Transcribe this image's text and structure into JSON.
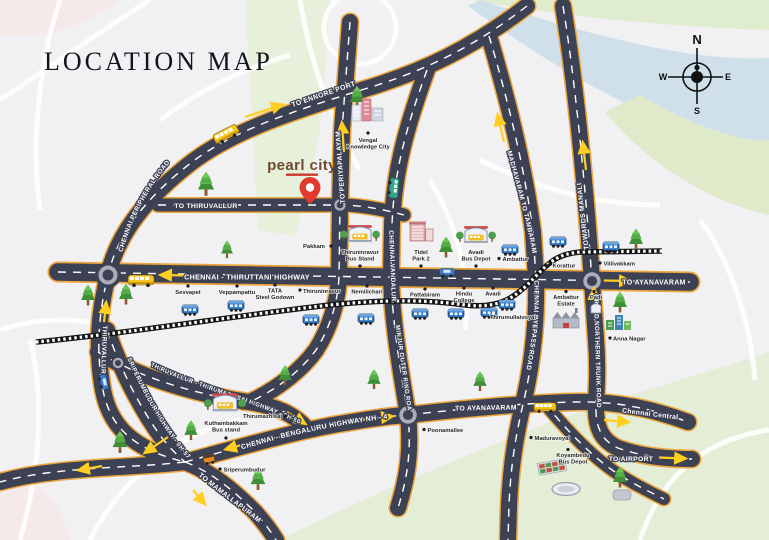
{
  "title": "LOCATION MAP",
  "logo": {
    "text": "pearl city"
  },
  "compass": {
    "n": "N",
    "s": "S",
    "e": "E",
    "w": "W"
  },
  "roads": {
    "ennore": "TO ENNORE PORT",
    "peripheral": "CHENNAI PERIPHERAL ROAD",
    "to_thiruvallur": "TO THIRUVALLUR",
    "periyapalayam": "TO PERIYAPALAYAM",
    "thiruttani": "CHENNAI - THIRUTTANI HIGHWAY",
    "vandalur": "CHENNAI VANDALUR",
    "minjur": "MINJUR OUTER RING ROAD",
    "madhavaram": "MADHAVARAM TO TAMBARAM",
    "manali": "TOWARDS MANALI",
    "byepass": "CHENNAI BYEPASS ROAD",
    "grand_northern": "GRAND NORTHERN TRUNK ROAD",
    "thiruvallur_v": "THIRUVALLUR -",
    "sh57": "SRIPERUMBUDUR HIGHWAY - SH-57",
    "sh50": "THIRUVALLUR - THIRUMAZHISAI HIGHWAY - SH-50",
    "nh4": "CHENNAI - BENGALURU HIGHWAY NH - 4",
    "mamallapuram": "TO MAMALLAPURAM",
    "ayanavaram_north": "TO AYANAVARAM",
    "ayanavaram_south": "TO AYANAVARAM",
    "central": "Chennai Central",
    "airport": "TO AIRPORT"
  },
  "places": {
    "vengal_knowledge_city": [
      "Vengal",
      "Knowledge City"
    ],
    "pakkam": "Pakkam",
    "thiruninravur_bus_stand": [
      "Thiruninravur",
      "Bus Stand"
    ],
    "tidel_park": [
      "Tidel",
      "Park 2"
    ],
    "avadi_bus_depot": [
      "Avadi",
      "Bus Depot"
    ],
    "ambattur": "Ambattur",
    "korattur": "Korattur",
    "villivakkam": "Villivakkam",
    "sevvapet": "Sevvapet",
    "veppampattu": "Veppampattu",
    "tata_steel": [
      "TATA",
      "Steel Godown"
    ],
    "thiruninravur": "Thiruninravur",
    "nemilichari": "Nemilichari",
    "pattabiram": "Pattabiram",
    "hindu_college": [
      "Hindu",
      "College"
    ],
    "avadi": "Avadi",
    "thirumullaivoyal": "Thirumullaivoyal",
    "ambattur_estate": [
      "Ambattur",
      "Estate"
    ],
    "padi": "Padi",
    "anna_nagar": "Anna Nagar",
    "kuthambakkam_bus_stand": [
      "Kuthambakkam",
      "Bus stand"
    ],
    "thirumazhisai": "Thirumazhisai",
    "sriperumbudur": "Sriperumbudur",
    "poonamallee": "Poonamallee",
    "maduravoyal": "Maduravoyal",
    "koyambedu_bus_depot": [
      "Koyambedu",
      "Bus Depot"
    ]
  },
  "icons": [
    "compass-rose-icon",
    "location-pin-icon",
    "tree-icon",
    "train-icon",
    "bus-icon",
    "car-icon",
    "green-bus-icon",
    "auto-rickshaw-icon",
    "bus-stand-icon",
    "building-icon",
    "factory-icon",
    "city-blocks-icon",
    "stadium-icon",
    "market-icon",
    "roundabout-icon",
    "railway-line",
    "direction-arrow-icon"
  ],
  "colors": {
    "background": "#f1f1f3",
    "road": "#3d4154",
    "road_edge": "#eda63c",
    "road_dash": "#ffffff",
    "railway": "#161616",
    "arrow": "#ffce1f",
    "pin": "#e23a2e",
    "logo_text": "#6f4a2e",
    "logo_accent": "#cc3b2f",
    "water": "#cfe0ea",
    "greenery": "#e4eed6",
    "label_dark": "#262626",
    "train": "#2f74c0",
    "bus": "#f6c61e",
    "tree": "#54ad45"
  }
}
